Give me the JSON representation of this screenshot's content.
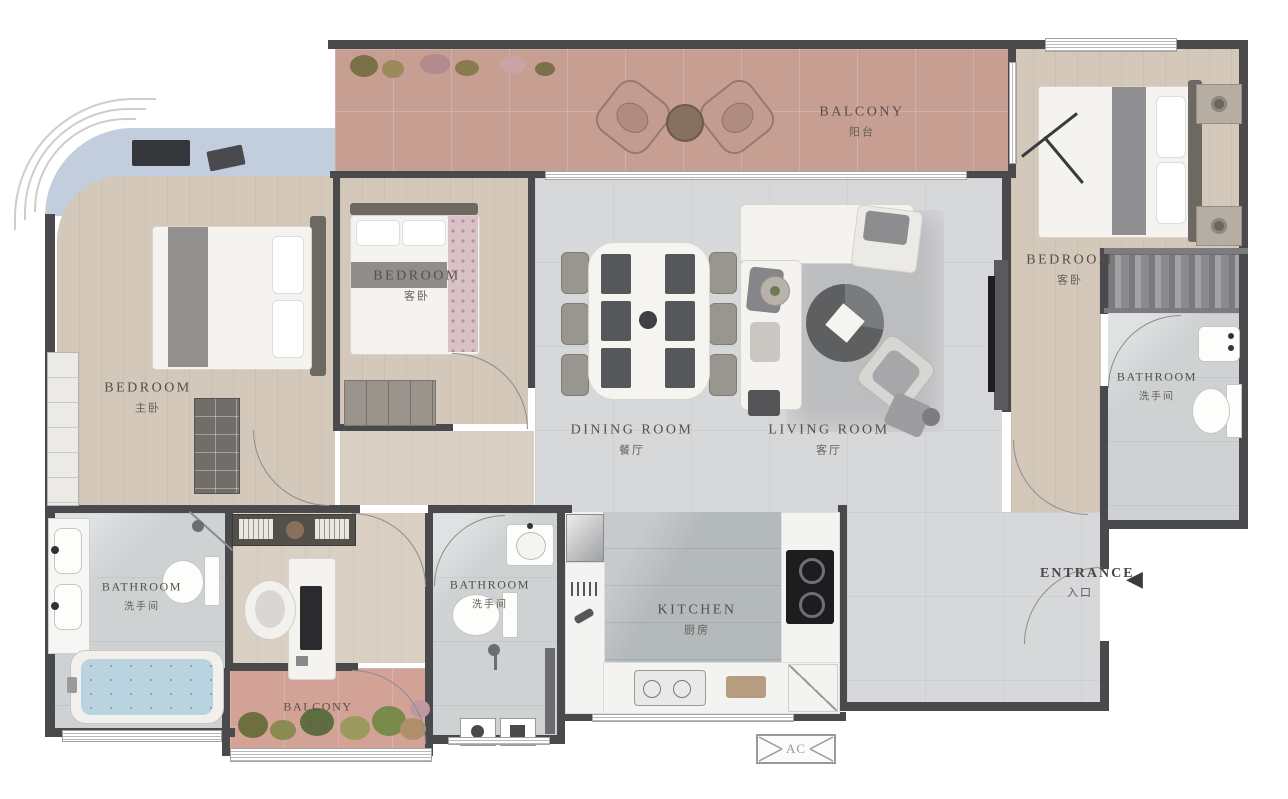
{
  "rooms": {
    "balcony_top": {
      "en": "BALCONY",
      "cn": "阳台"
    },
    "bedroom_master": {
      "en": "BEDROOM",
      "cn": "主卧"
    },
    "bedroom_guest": {
      "en": "BEDROOM",
      "cn": "客卧"
    },
    "bedroom_right": {
      "en": "BEDROOM",
      "cn": "客卧"
    },
    "dining_room": {
      "en": "DINING ROOM",
      "cn": "餐厅"
    },
    "living_room": {
      "en": "LIVING ROOM",
      "cn": "客厅"
    },
    "bathroom_right": {
      "en": "BATHROOM",
      "cn": "洗手间"
    },
    "bathroom_left": {
      "en": "BATHROOM",
      "cn": "洗手间"
    },
    "bathroom_mid": {
      "en": "BATHROOM",
      "cn": "洗手间"
    },
    "kitchen": {
      "en": "KITCHEN",
      "cn": "厨房"
    },
    "balcony_bottom": {
      "en": "BALCONY",
      "cn": "阳台"
    }
  },
  "entrance": {
    "en": "ENTRANCE",
    "cn": "入口",
    "arrow": "◀"
  },
  "ac_label": "AC",
  "colors": {
    "wall": "#4a4a4d",
    "wood_floor": "#d3c8b9",
    "grey_tile": "#d6d8d9",
    "terracotta_balcony": "#c69e92",
    "pink_balcony": "#d2a296",
    "bay_window_seat": "#c2cedd",
    "marble": "#ced2d3",
    "label_text": "#564f47"
  }
}
